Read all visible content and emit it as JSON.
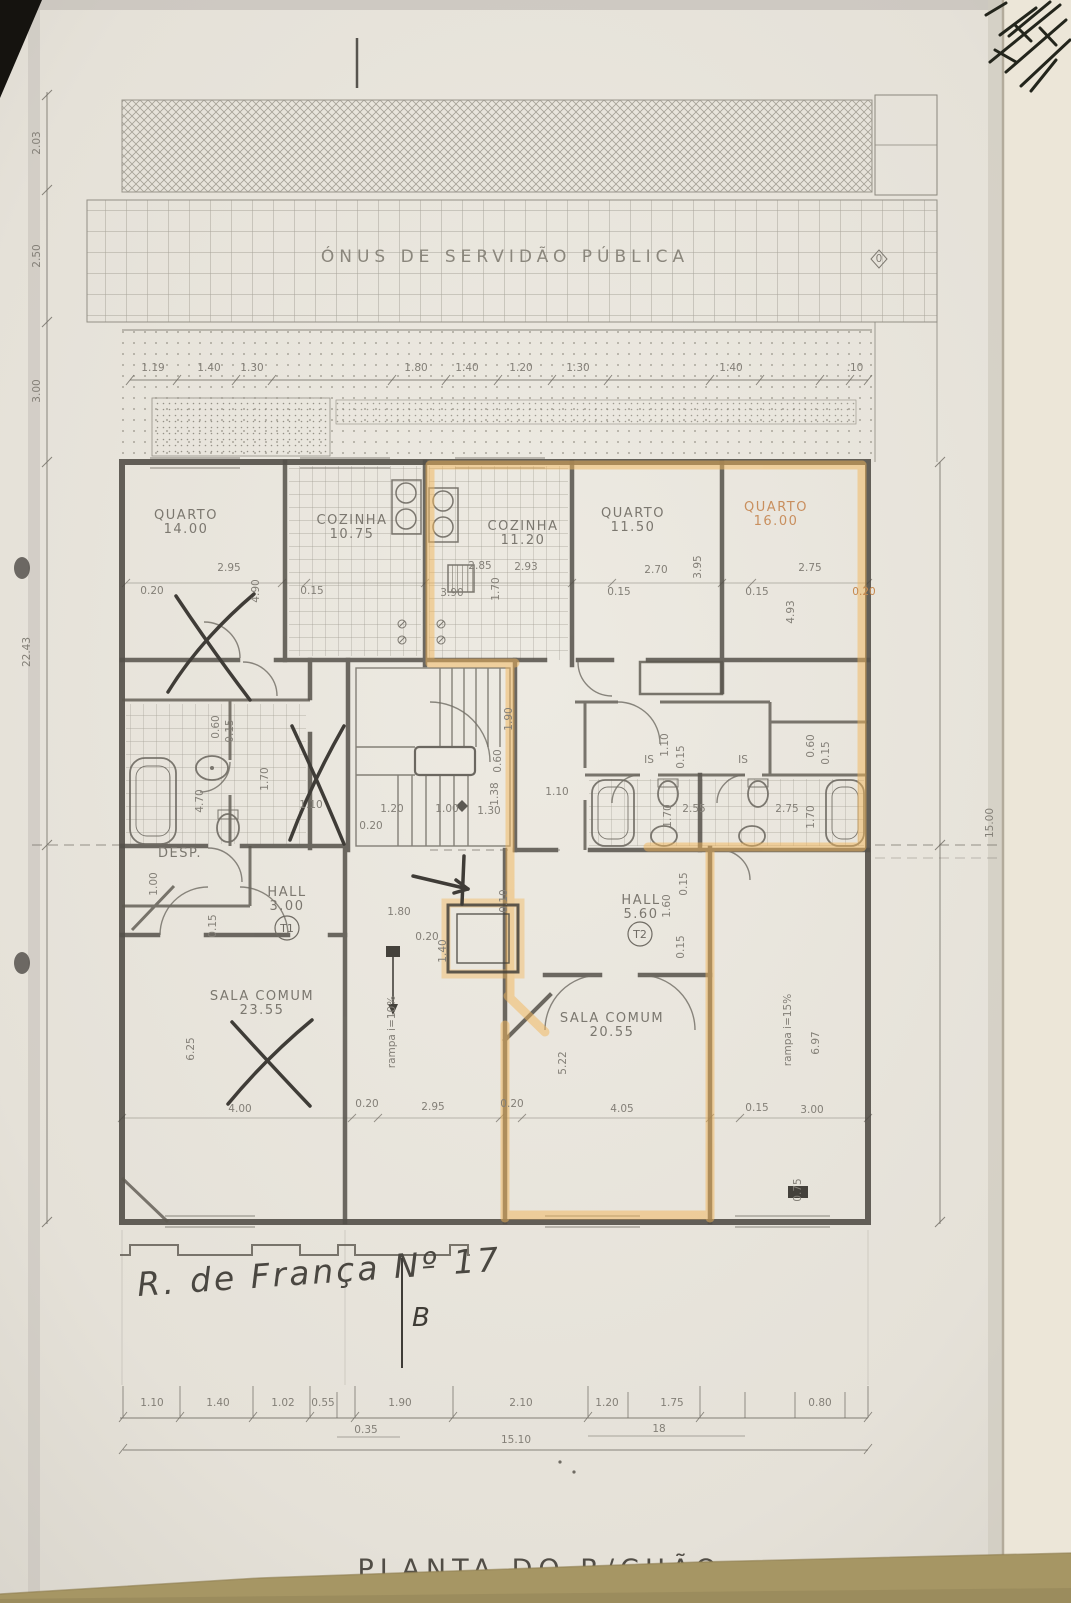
{
  "document": {
    "title": "PLANTA DO R/CHÃO",
    "address_note": "R. de França Nº 17",
    "section_letter": "B",
    "servidao_label": "ÓNUS DE SERVIDÃO PÚBLICA"
  },
  "units": [
    {
      "code": "T1"
    },
    {
      "code": "T2"
    }
  ],
  "colors": {
    "paper": "#e7e3db",
    "pencil_wall": "#4a463f",
    "pencil_light": "#7e7a71",
    "highlighter_orange": "#f2b65a",
    "desk_surface": "#a69664",
    "dark_corner": "#15130f"
  },
  "rooms": [
    {
      "name": "QUARTO",
      "area": "14.00",
      "x": 186,
      "y": 519
    },
    {
      "name": "COZINHA",
      "area": "10.75",
      "x": 352,
      "y": 524
    },
    {
      "name": "COZINHA",
      "area": "11.20",
      "x": 523,
      "y": 530
    },
    {
      "name": "QUARTO",
      "area": "11.50",
      "x": 633,
      "y": 517
    },
    {
      "name": "QUARTO",
      "area": "16.00",
      "x": 776,
      "y": 511,
      "hl": true
    },
    {
      "name": "SALA COMUM",
      "area": "23.55",
      "x": 262,
      "y": 1000
    },
    {
      "name": "SALA COMUM",
      "area": "20.55",
      "x": 612,
      "y": 1022
    },
    {
      "name": "HALL",
      "area": "3.00",
      "x": 287,
      "y": 896
    },
    {
      "name": "HALL",
      "area": "5.60",
      "x": 641,
      "y": 904
    }
  ],
  "annotations": [
    {
      "t": "1.19",
      "x": 153,
      "y": 371
    },
    {
      "t": "1.40",
      "x": 209,
      "y": 371
    },
    {
      "t": "1.30",
      "x": 252,
      "y": 371
    },
    {
      "t": "1.80",
      "x": 416,
      "y": 371
    },
    {
      "t": "1.40",
      "x": 467,
      "y": 371
    },
    {
      "t": "1.20",
      "x": 521,
      "y": 371
    },
    {
      "t": "1.30",
      "x": 578,
      "y": 371
    },
    {
      "t": "1.40",
      "x": 731,
      "y": 371
    },
    {
      "t": ".10",
      "x": 855,
      "y": 371
    },
    {
      "t": "2.03",
      "x": 40,
      "y": 143,
      "r": -90
    },
    {
      "t": "2.50",
      "x": 40,
      "y": 256,
      "r": -90
    },
    {
      "t": "3.00",
      "x": 40,
      "y": 391,
      "r": -90
    },
    {
      "t": "22.43",
      "x": 30,
      "y": 652,
      "r": -90
    },
    {
      "t": "15.00",
      "x": 993,
      "y": 823,
      "r": -90,
      "s": 11
    },
    {
      "t": "0",
      "x": 879,
      "y": 262,
      "s": 8
    },
    {
      "t": "0.20",
      "x": 152,
      "y": 594
    },
    {
      "t": "2.95",
      "x": 229,
      "y": 571
    },
    {
      "t": "4.90",
      "x": 259,
      "y": 591,
      "r": -90
    },
    {
      "t": "0.15",
      "x": 312,
      "y": 594
    },
    {
      "t": "2.85",
      "x": 480,
      "y": 569
    },
    {
      "t": "3.90",
      "x": 452,
      "y": 596
    },
    {
      "t": "1.70",
      "x": 499,
      "y": 589,
      "r": -90
    },
    {
      "t": "2.93",
      "x": 526,
      "y": 570
    },
    {
      "t": "0.15",
      "x": 619,
      "y": 595
    },
    {
      "t": "2.70",
      "x": 656,
      "y": 573
    },
    {
      "t": "0.15",
      "x": 757,
      "y": 595
    },
    {
      "t": "2.75",
      "x": 810,
      "y": 571
    },
    {
      "t": "0.20",
      "x": 864,
      "y": 595,
      "c": "dim-hl"
    },
    {
      "t": "4.93",
      "x": 794,
      "y": 612,
      "r": -90
    },
    {
      "t": "3.95",
      "x": 701,
      "y": 567,
      "r": -90
    },
    {
      "t": "0.60",
      "x": 219,
      "y": 727,
      "r": -90
    },
    {
      "t": "0.15",
      "x": 233,
      "y": 731,
      "r": -90
    },
    {
      "t": "1.70",
      "x": 268,
      "y": 779,
      "r": -90
    },
    {
      "t": "4.70",
      "x": 203,
      "y": 801,
      "r": -90
    },
    {
      "t": "1.10",
      "x": 311,
      "y": 808
    },
    {
      "t": "1.00",
      "x": 157,
      "y": 884,
      "r": -90
    },
    {
      "t": "0.15",
      "x": 216,
      "y": 926,
      "r": -90
    },
    {
      "t": "1.90",
      "x": 512,
      "y": 719,
      "r": -90
    },
    {
      "t": "0.60",
      "x": 501,
      "y": 761,
      "r": -90
    },
    {
      "t": "1.38",
      "x": 498,
      "y": 794,
      "r": -90
    },
    {
      "t": "1.30",
      "x": 489,
      "y": 814
    },
    {
      "t": "1.20",
      "x": 392,
      "y": 812
    },
    {
      "t": "1.00",
      "x": 447,
      "y": 812
    },
    {
      "t": "0.20",
      "x": 371,
      "y": 829
    },
    {
      "t": "1.10",
      "x": 668,
      "y": 745,
      "r": -90
    },
    {
      "t": "0.15",
      "x": 684,
      "y": 757,
      "r": -90
    },
    {
      "t": "0.60",
      "x": 814,
      "y": 746,
      "r": -90
    },
    {
      "t": "0.15",
      "x": 829,
      "y": 753,
      "r": -90
    },
    {
      "t": "1.70",
      "x": 671,
      "y": 816,
      "r": -90
    },
    {
      "t": "2.55",
      "x": 694,
      "y": 812
    },
    {
      "t": "2.75",
      "x": 787,
      "y": 812
    },
    {
      "t": "1.70",
      "x": 814,
      "y": 817,
      "r": -90
    },
    {
      "t": "1.10",
      "x": 557,
      "y": 795
    },
    {
      "t": "IS",
      "x": 649,
      "y": 763,
      "s": 9.5,
      "n": "room-label"
    },
    {
      "t": "IS",
      "x": 743,
      "y": 763,
      "s": 9.5,
      "n": "room-label"
    },
    {
      "t": "DESP.",
      "x": 180,
      "y": 857,
      "c": "room",
      "s": 10.5,
      "n": "room-label"
    },
    {
      "t": "1.80",
      "x": 399,
      "y": 915
    },
    {
      "t": "0.20",
      "x": 427,
      "y": 940
    },
    {
      "t": "1.40",
      "x": 446,
      "y": 951,
      "r": -90
    },
    {
      "t": "0.10",
      "x": 507,
      "y": 901,
      "r": -90
    },
    {
      "t": "1.60",
      "x": 670,
      "y": 906,
      "r": -90
    },
    {
      "t": "0.15",
      "x": 687,
      "y": 884,
      "r": -90
    },
    {
      "t": "0.15",
      "x": 684,
      "y": 947,
      "r": -90
    },
    {
      "t": "rampa i=10%",
      "x": 395,
      "y": 1032,
      "r": -90,
      "s": 11,
      "n": "ramp-label"
    },
    {
      "t": "rampa i=15%",
      "x": 791,
      "y": 1030,
      "r": -90,
      "s": 11,
      "n": "ramp-label"
    },
    {
      "t": "6.25",
      "x": 194,
      "y": 1049,
      "r": -90
    },
    {
      "t": "5.22",
      "x": 566,
      "y": 1063,
      "r": -90
    },
    {
      "t": "6.97",
      "x": 819,
      "y": 1043,
      "r": -90
    },
    {
      "t": "4.00",
      "x": 240,
      "y": 1112
    },
    {
      "t": "0.20",
      "x": 367,
      "y": 1107
    },
    {
      "t": "2.95",
      "x": 433,
      "y": 1110
    },
    {
      "t": "0.20",
      "x": 512,
      "y": 1107
    },
    {
      "t": "4.05",
      "x": 622,
      "y": 1112
    },
    {
      "t": "0.15",
      "x": 757,
      "y": 1111
    },
    {
      "t": "3.00",
      "x": 812,
      "y": 1113
    },
    {
      "t": "0.75",
      "x": 801,
      "y": 1190,
      "r": -90
    },
    {
      "t": "1.10",
      "x": 152,
      "y": 1406
    },
    {
      "t": "1.40",
      "x": 218,
      "y": 1406
    },
    {
      "t": "1.02",
      "x": 283,
      "y": 1406
    },
    {
      "t": "0.55",
      "x": 323,
      "y": 1406
    },
    {
      "t": "1.90",
      "x": 400,
      "y": 1406
    },
    {
      "t": "2.10",
      "x": 521,
      "y": 1406
    },
    {
      "t": "1.20",
      "x": 607,
      "y": 1406
    },
    {
      "t": "1.75",
      "x": 672,
      "y": 1406
    },
    {
      "t": "0.80",
      "x": 820,
      "y": 1406
    },
    {
      "t": "0.35",
      "x": 366,
      "y": 1433
    },
    {
      "t": "18",
      "x": 659,
      "y": 1432
    },
    {
      "t": "15.10",
      "x": 516,
      "y": 1443
    }
  ]
}
